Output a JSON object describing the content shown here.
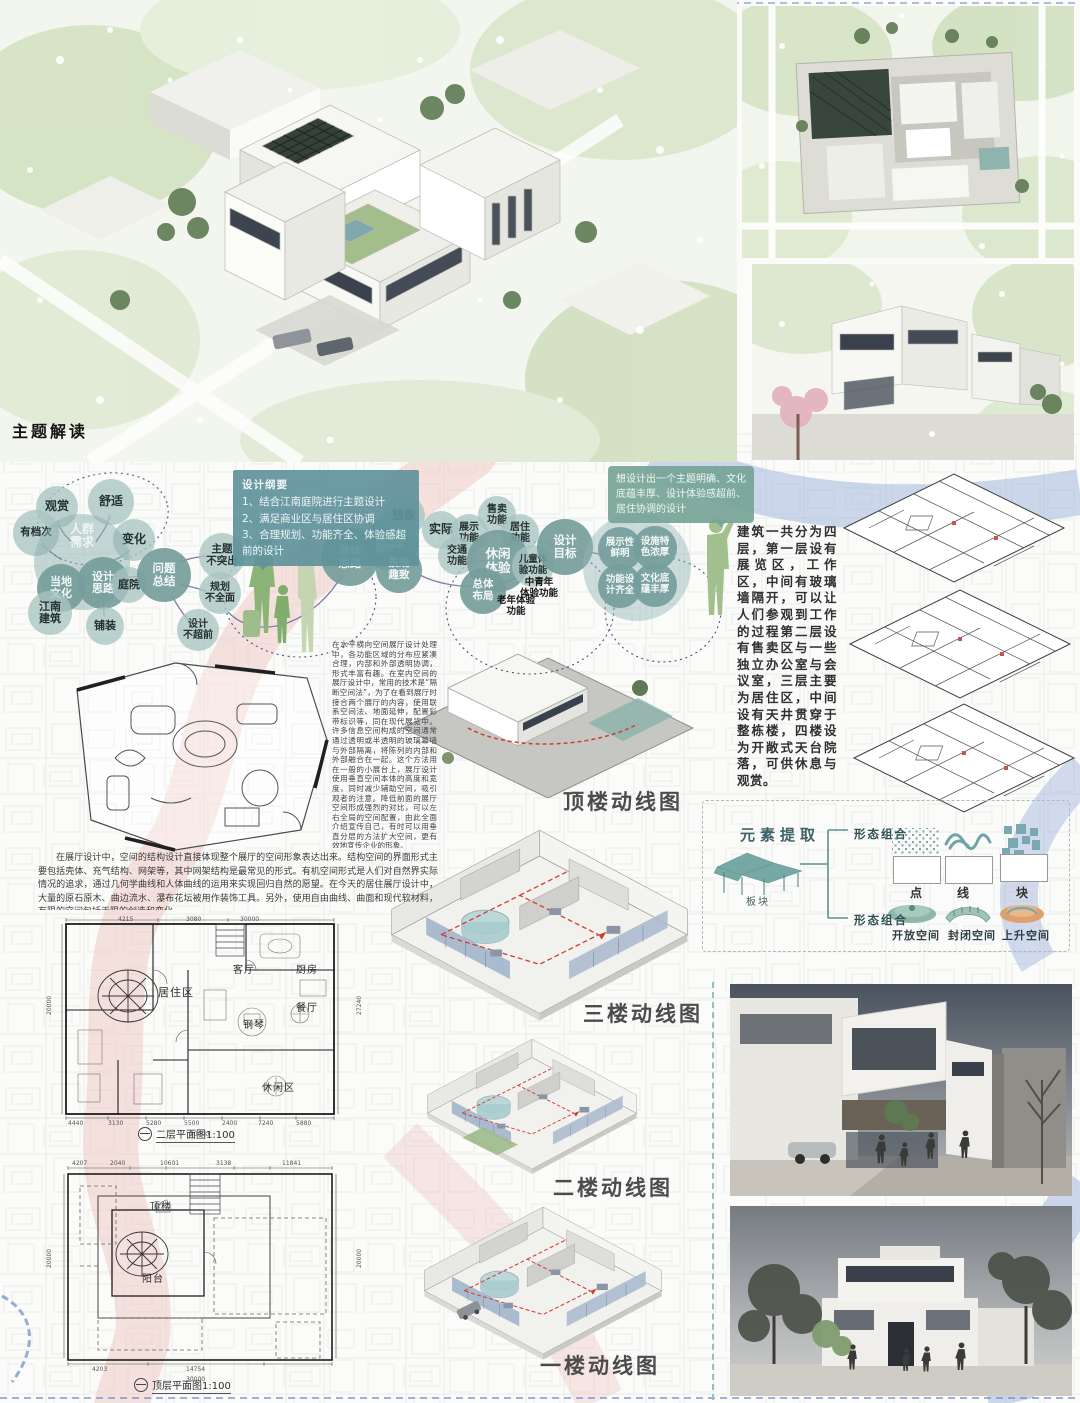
{
  "colors": {
    "teal": "#6f9fa6",
    "deep_teal": "#769e9c",
    "pink_river": "#eec3bd",
    "blue_river": "#93a8d6",
    "green_fig": "#8fb87c",
    "red_path": "#d23b2f"
  },
  "theme": {
    "title": "主题解读"
  },
  "outline": {
    "title": "设计纲要",
    "items": [
      "1、结合江南庭院进行主题设计",
      "2、满足商业区与居住区协调",
      "3、合理规划、功能齐全、体验感超前的设计"
    ]
  },
  "speech": "想设计出一个主题明确、文化底蕴丰厚、设计体验感超前、居住协调的设计",
  "bubbles": [
    {
      "t": "观赏",
      "cx": 57,
      "cy": 507,
      "r": 21
    },
    {
      "t": "舒适",
      "cx": 111,
      "cy": 502,
      "r": 23
    },
    {
      "t": "变化",
      "cx": 134,
      "cy": 540,
      "r": 21
    },
    {
      "t": "有档次",
      "cx": 36,
      "cy": 533,
      "r": 23,
      "fs": 10.5
    },
    {
      "t": "人群\n需求",
      "cx": 82,
      "cy": 562,
      "r": 48,
      "cls": "big",
      "fs": 12
    },
    {
      "t": "当地\n文化",
      "cx": 61,
      "cy": 588,
      "r": 24,
      "cls": "deep",
      "fs": 11
    },
    {
      "t": "设计\n思路",
      "cx": 103,
      "cy": 583,
      "r": 26,
      "cls": "deep",
      "fs": 11
    },
    {
      "t": "庭院",
      "cx": 129,
      "cy": 585,
      "r": 18,
      "fs": 11
    },
    {
      "t": "江南\n建筑",
      "cx": 50,
      "cy": 613,
      "r": 22,
      "fs": 11
    },
    {
      "t": "铺装",
      "cx": 105,
      "cy": 626,
      "r": 19,
      "fs": 11
    },
    {
      "t": "问题\n总结",
      "cx": 164,
      "cy": 575,
      "r": 27,
      "cls": "deep",
      "fs": 11.5
    },
    {
      "t": "主题\n不突出",
      "cx": 222,
      "cy": 556,
      "r": 23,
      "fs": 10.5
    },
    {
      "t": "规划\n不全面",
      "cx": 220,
      "cy": 593,
      "r": 21,
      "fs": 10
    },
    {
      "t": "设计\n不超前",
      "cx": 198,
      "cy": 630,
      "r": 21,
      "fs": 10
    },
    {
      "t": "总体\n思路",
      "cx": 350,
      "cy": 557,
      "r": 29,
      "cls": "deep",
      "fs": 11.5
    },
    {
      "t": "江南庭\n院特色",
      "cx": 391,
      "cy": 544,
      "r": 27,
      "cls": "deep",
      "fs": 10
    },
    {
      "t": "景观\n趣致",
      "cx": 399,
      "cy": 570,
      "r": 23,
      "cls": "deep",
      "fs": 10.5
    },
    {
      "t": "想象",
      "cx": 404,
      "cy": 516,
      "r": 21
    },
    {
      "t": "实际",
      "cx": 441,
      "cy": 530,
      "r": 19
    },
    {
      "t": "展示\n功能",
      "cx": 469,
      "cy": 533,
      "r": 19,
      "fs": 10
    },
    {
      "t": "交通\n功能",
      "cx": 457,
      "cy": 556,
      "r": 19,
      "fs": 10
    },
    {
      "t": "售卖\n功能",
      "cx": 497,
      "cy": 515,
      "r": 19,
      "fs": 10
    },
    {
      "t": "居住\n功能",
      "cx": 520,
      "cy": 533,
      "r": 19,
      "fs": 10
    },
    {
      "t": "休闲\n体验",
      "cx": 498,
      "cy": 561,
      "r": 31,
      "cls": "deep",
      "fs": 12.5
    },
    {
      "t": "儿童体\n验功能",
      "cx": 533,
      "cy": 566,
      "r": 21,
      "fs": 9.5
    },
    {
      "t": "总体\n布局",
      "cx": 483,
      "cy": 591,
      "r": 23,
      "cls": "deep",
      "fs": 10.5
    },
    {
      "t": "设计\n目标",
      "cx": 565,
      "cy": 547,
      "r": 28,
      "cls": "deep",
      "fs": 11.5
    },
    {
      "t": "",
      "cx": 637,
      "cy": 567,
      "r": 54,
      "cls": "halo"
    },
    {
      "t": "展示性\n鲜明",
      "cx": 620,
      "cy": 549,
      "r": 22,
      "cls": "deep",
      "fs": 9.5
    },
    {
      "t": "设施特\n色浓厚",
      "cx": 655,
      "cy": 548,
      "r": 22,
      "cls": "deep",
      "fs": 9.5
    },
    {
      "t": "功能设\n计齐全",
      "cx": 620,
      "cy": 586,
      "r": 22,
      "cls": "deep",
      "fs": 9.5
    },
    {
      "t": "文化底\n蕴丰厚",
      "cx": 655,
      "cy": 585,
      "r": 22,
      "cls": "deep",
      "fs": 9.5
    },
    {
      "t": "中青年\n体验功能",
      "x": 508,
      "y": 578,
      "w": 62,
      "cls": "plain",
      "fs": 9.5
    },
    {
      "t": "老年体验\n功能",
      "x": 486,
      "y": 596,
      "w": 60,
      "cls": "plain",
      "fs": 9.5
    }
  ],
  "building_description": "建筑一共分为四层，第一层设有展览区，工作区，中间有玻璃墙隔开，可以让人们参观到工作的过程第二层设有售卖区与一些独立办公室与会议室，三层主要为居住区，中间设有天井贯穿于整栋楼，四楼设为开敞式天台院落，可供休息与观赏。",
  "paragraph_vertical": "在水平横向空间展厅设计处理中，各功能区域的分布应紧凑合理，内部和外部透明协调，形式丰富有趣。在室内空间的展厅设计中，常用的技术是“隔断空间法”，为了在看到展厅时接合两个展厅的内容，使用联系空间法、地面延伸，配置彩带标识等，同在现代展览中。许多信息空间构成的空间通常通过透明或半透明的玻璃幕墙与外部隔离，将陈列的内部和外部融合在一起。这个方法用在一般的小展台上，展厅设计使用垂直空间本体的高度和宽度，同时减少辅助空间，吸引观者的注意。降低前面的展厅空间形成强烈的对比，可以左右全局的空间配置，由此全面介绍宣传自己，有时可以用垂直分层的方法扩大空间，更有效地宣传企业的形象。",
  "paragraph_bottom": "在展厅设计中，空间的结构设计直接体现整个展厅的空间形象表达出来。结构空间的界面形式主要包括壳体、充气结构、网架等，其中网架结构是最常见的形式。有机空间形式是人们对自然界实际情况的追求，通过几何学曲线和人体曲线的运用来实现回归自然的愿望。在今天的居住展厅设计中，大量的原石原木、曲边流水、瀑布花坛被用作装饰工具。另外，使用自由曲线、曲面和现代软材料，有限的空间包括无限的创造和变化。",
  "circulation_labels": [
    {
      "t": "顶楼动线图",
      "x": 563,
      "y": 786
    },
    {
      "t": "三楼动线图",
      "x": 583,
      "y": 998
    },
    {
      "t": "二楼动线图",
      "x": 553,
      "y": 1172
    },
    {
      "t": "一楼动线图",
      "x": 540,
      "y": 1350
    }
  ],
  "plan_captions": {
    "second": "二层平面图1:100",
    "roof": "顶层平面图1:100"
  },
  "rooms_second": [
    {
      "t": "居住区",
      "x": 158,
      "y": 984,
      "fs": 11
    },
    {
      "t": "客厅",
      "x": 233,
      "y": 961
    },
    {
      "t": "厨房",
      "x": 296,
      "y": 961
    },
    {
      "t": "餐厅",
      "x": 296,
      "y": 999
    },
    {
      "t": "钢琴",
      "x": 243,
      "y": 1016
    },
    {
      "t": "休闲区",
      "x": 262,
      "y": 1079
    }
  ],
  "rooms_roof": [
    {
      "t": "顶楼",
      "x": 150,
      "y": 1198
    },
    {
      "t": "阳台",
      "x": 142,
      "y": 1270
    }
  ],
  "dims_second": [
    {
      "t": "4215",
      "x": 118,
      "y": 916
    },
    {
      "t": "3080",
      "x": 186,
      "y": 916
    },
    {
      "t": "30000",
      "x": 240,
      "y": 916
    },
    {
      "t": "20000",
      "x": 46,
      "y": 1015,
      "cls": "v"
    },
    {
      "t": "27240",
      "x": 356,
      "y": 1015,
      "cls": "v"
    },
    {
      "t": "4440",
      "x": 68,
      "y": 1120
    },
    {
      "t": "3130",
      "x": 108,
      "y": 1120
    },
    {
      "t": "5280",
      "x": 146,
      "y": 1120
    },
    {
      "t": "5500",
      "x": 184,
      "y": 1120
    },
    {
      "t": "2400",
      "x": 222,
      "y": 1120
    },
    {
      "t": "7240",
      "x": 258,
      "y": 1120
    },
    {
      "t": "5880",
      "x": 296,
      "y": 1120
    },
    {
      "t": "30000",
      "x": 190,
      "y": 1131
    }
  ],
  "dims_roof": [
    {
      "t": "4207",
      "x": 72,
      "y": 1160
    },
    {
      "t": "2040",
      "x": 110,
      "y": 1160
    },
    {
      "t": "10601",
      "x": 160,
      "y": 1160
    },
    {
      "t": "3138",
      "x": 216,
      "y": 1160
    },
    {
      "t": "11841",
      "x": 282,
      "y": 1160
    },
    {
      "t": "20000",
      "x": 46,
      "y": 1268,
      "cls": "v"
    },
    {
      "t": "20000",
      "x": 356,
      "y": 1268,
      "cls": "v"
    },
    {
      "t": "4203",
      "x": 92,
      "y": 1366
    },
    {
      "t": "14754",
      "x": 186,
      "y": 1366
    },
    {
      "t": "30000",
      "x": 186,
      "y": 1376
    }
  ],
  "elements": {
    "title": "元素提取",
    "canopy_label": "板块",
    "combo_label": "形态组合",
    "primitives": [
      {
        "t": "点",
        "x": 910,
        "y": 884
      },
      {
        "t": "线",
        "x": 957,
        "y": 884
      },
      {
        "t": "块",
        "x": 1016,
        "y": 884
      }
    ],
    "spaces": [
      {
        "t": "开放空间",
        "x": 892,
        "y": 927
      },
      {
        "t": "封闭空间",
        "x": 948,
        "y": 927
      },
      {
        "t": "上升空间",
        "x": 1002,
        "y": 927
      }
    ]
  }
}
